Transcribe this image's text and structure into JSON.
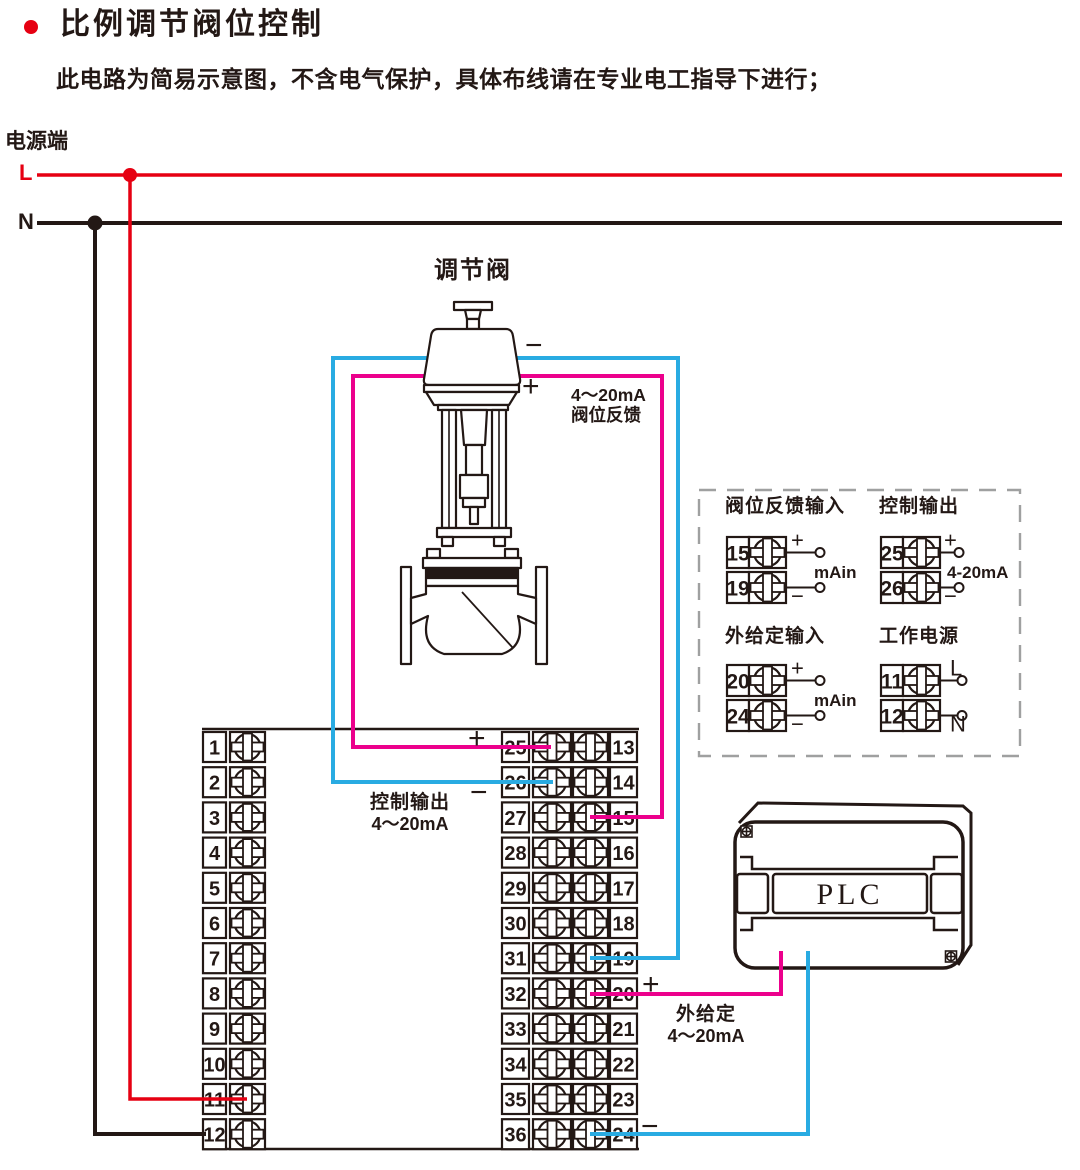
{
  "header": {
    "title": "比例调节阀位控制",
    "subtitle": "此电路为简易示意图，不含电气保护，具体布线请在专业电工指导下进行；",
    "bullet_color": "#e60012"
  },
  "power": {
    "label": "电源端",
    "l": "L",
    "n": "N"
  },
  "valve": {
    "name": "调节阀",
    "minus": "−",
    "plus": "+",
    "feedback": [
      "4～20mA",
      "阀位反馈"
    ]
  },
  "control_output": {
    "label": [
      "控制输出",
      "4～20mA"
    ],
    "plus": "+",
    "minus": "−"
  },
  "external_set": {
    "label": [
      "外给定",
      "4～20mA"
    ],
    "plus": "+",
    "minus": "−"
  },
  "plc": {
    "label": "PLC"
  },
  "terminals": {
    "left": [
      "1",
      "2",
      "3",
      "4",
      "5",
      "6",
      "7",
      "8",
      "9",
      "10",
      "11",
      "12"
    ],
    "middle": [
      "25",
      "26",
      "27",
      "28",
      "29",
      "30",
      "31",
      "32",
      "33",
      "34",
      "35",
      "36"
    ],
    "right": [
      "13",
      "14",
      "15",
      "16",
      "17",
      "18",
      "19",
      "20",
      "21",
      "22",
      "23",
      "24"
    ]
  },
  "io_panel": {
    "groups": [
      {
        "title": "阀位反馈输入",
        "rows": [
          {
            "no": "15",
            "tag": "+"
          },
          {
            "no": "19",
            "tag": "−"
          }
        ],
        "mid_label": "mAin"
      },
      {
        "title": "控制输出",
        "rows": [
          {
            "no": "25",
            "tag": "+"
          },
          {
            "no": "26",
            "tag": "−"
          }
        ],
        "mid_label": "4-20mA"
      },
      {
        "title": "外给定输入",
        "rows": [
          {
            "no": "20",
            "tag": "+"
          },
          {
            "no": "24",
            "tag": "−"
          }
        ],
        "mid_label": "mAin"
      },
      {
        "title": "工作电源",
        "rows": [
          {
            "no": "11",
            "tag": "L"
          },
          {
            "no": "12",
            "tag": "N"
          }
        ],
        "mid_label": ""
      }
    ]
  },
  "colors": {
    "live": "#e60012",
    "neutral": "#231815",
    "blue": "#29abe2",
    "pink": "#ec008c",
    "outline": "#231815",
    "dash": "#9fa0a0"
  }
}
